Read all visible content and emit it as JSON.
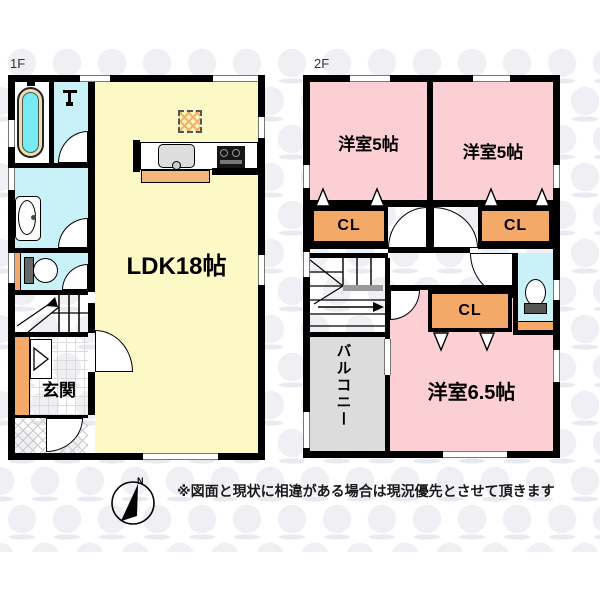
{
  "floors": {
    "f1": {
      "label": "1F",
      "rooms": {
        "ldk": "LDK18帖",
        "genkan": "玄関"
      }
    },
    "f2": {
      "label": "2F",
      "rooms": {
        "bed_left": "洋室5帖",
        "bed_right": "洋室5帖",
        "bed_main": "洋室6.5帖",
        "balcony": "バルコニー",
        "closet_left": "CL",
        "closet_right": "CL",
        "closet_main": "CL"
      }
    }
  },
  "compass": {
    "north": "N"
  },
  "note": "※図面と現状に相違がある場合は現況優先とさせて頂きます",
  "colors": {
    "ldk": "#fcf9c6",
    "bedroom": "#fbcfd3",
    "closet": "#f4a968",
    "wet_room": "#c8f2f7",
    "tub_water": "#76ebf3",
    "counter": "#f5b87c",
    "balcony": "#dcdcdc",
    "wall": "#000000"
  }
}
